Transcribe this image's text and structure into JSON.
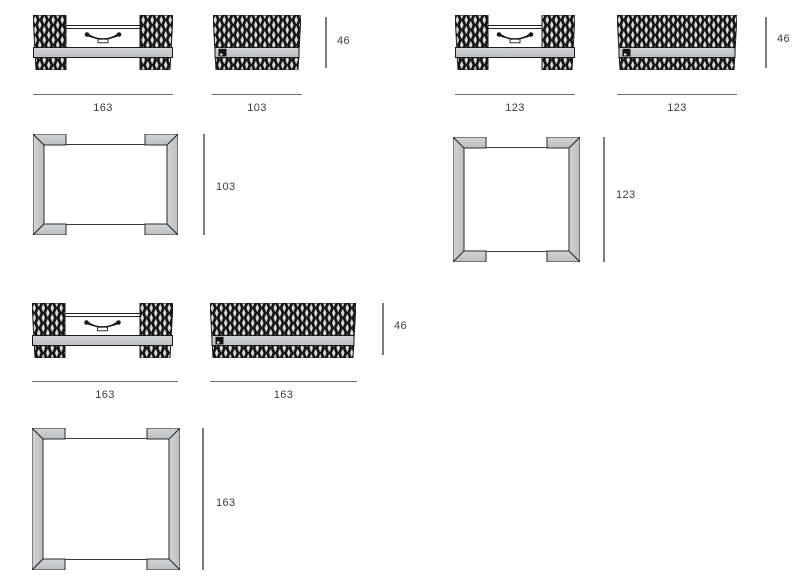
{
  "page": {
    "type": "furniture-dimension-diagram",
    "background": "#ffffff"
  },
  "colors": {
    "weave_dark": "#161616",
    "weave_light": "#d9d9d9",
    "frame_gray": "#c6c7c9",
    "outline": "#1a1a1a",
    "dimension_line": "#7d7d7d",
    "label_text": "#3d3d3d"
  },
  "groups": [
    {
      "id": "table-163x103",
      "front_width": "163",
      "side_depth": "103",
      "height": "46",
      "top_depth": "103"
    },
    {
      "id": "table-123x123",
      "front_width": "123",
      "side_depth": "123",
      "height": "46",
      "top_depth": "123"
    },
    {
      "id": "table-163x163",
      "front_width": "163",
      "side_depth": "163",
      "height": "46",
      "top_depth": "163"
    }
  ]
}
